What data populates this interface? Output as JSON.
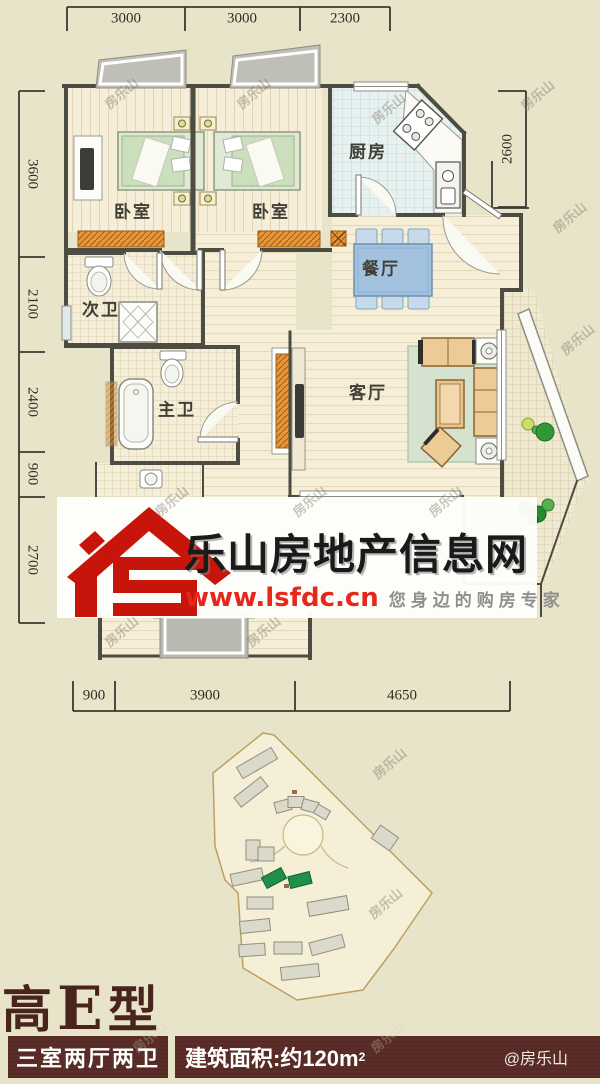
{
  "floor_plan": {
    "rooms": [
      {
        "id": "bedroom-left",
        "label": "卧室"
      },
      {
        "id": "bedroom-right",
        "label": "卧室"
      },
      {
        "id": "kitchen",
        "label": "厨房"
      },
      {
        "id": "dining",
        "label": "餐厅"
      },
      {
        "id": "bath-secondary",
        "label": "次卫"
      },
      {
        "id": "bath-master",
        "label": "主卫"
      },
      {
        "id": "living",
        "label": "客厅"
      }
    ],
    "dimensions": {
      "top": [
        "3000",
        "3000",
        "2300"
      ],
      "left": [
        "3600",
        "2100",
        "2400",
        "900",
        "2700"
      ],
      "right": [
        "2600"
      ],
      "bottom": [
        "900",
        "3900",
        "4650"
      ]
    }
  },
  "branding": {
    "logo_monogram": "LS",
    "site_name": "乐山房地产信息网",
    "site_url": "www.lsfdc.cn",
    "slogan": "您身边的购房专家"
  },
  "watermark": {
    "text": "房乐山",
    "credit": "@房乐山"
  },
  "unit_info": {
    "title_prefix": "高",
    "title_letter": "E",
    "title_suffix": "型",
    "layout": "三室两厅两卫",
    "area_label": "建筑面积:约120m",
    "area_sup": "2"
  },
  "colors": {
    "page_bg": "#e8e4ca",
    "logo_red": "#c8150c",
    "url_red": "#e5281a",
    "slogan_gray": "#8f8f8f",
    "title_brown": "#49241d",
    "bar_maroon": "#5a2d28",
    "sill_orange": "#e6973c",
    "site_highlight_green": "#1f8f49"
  }
}
